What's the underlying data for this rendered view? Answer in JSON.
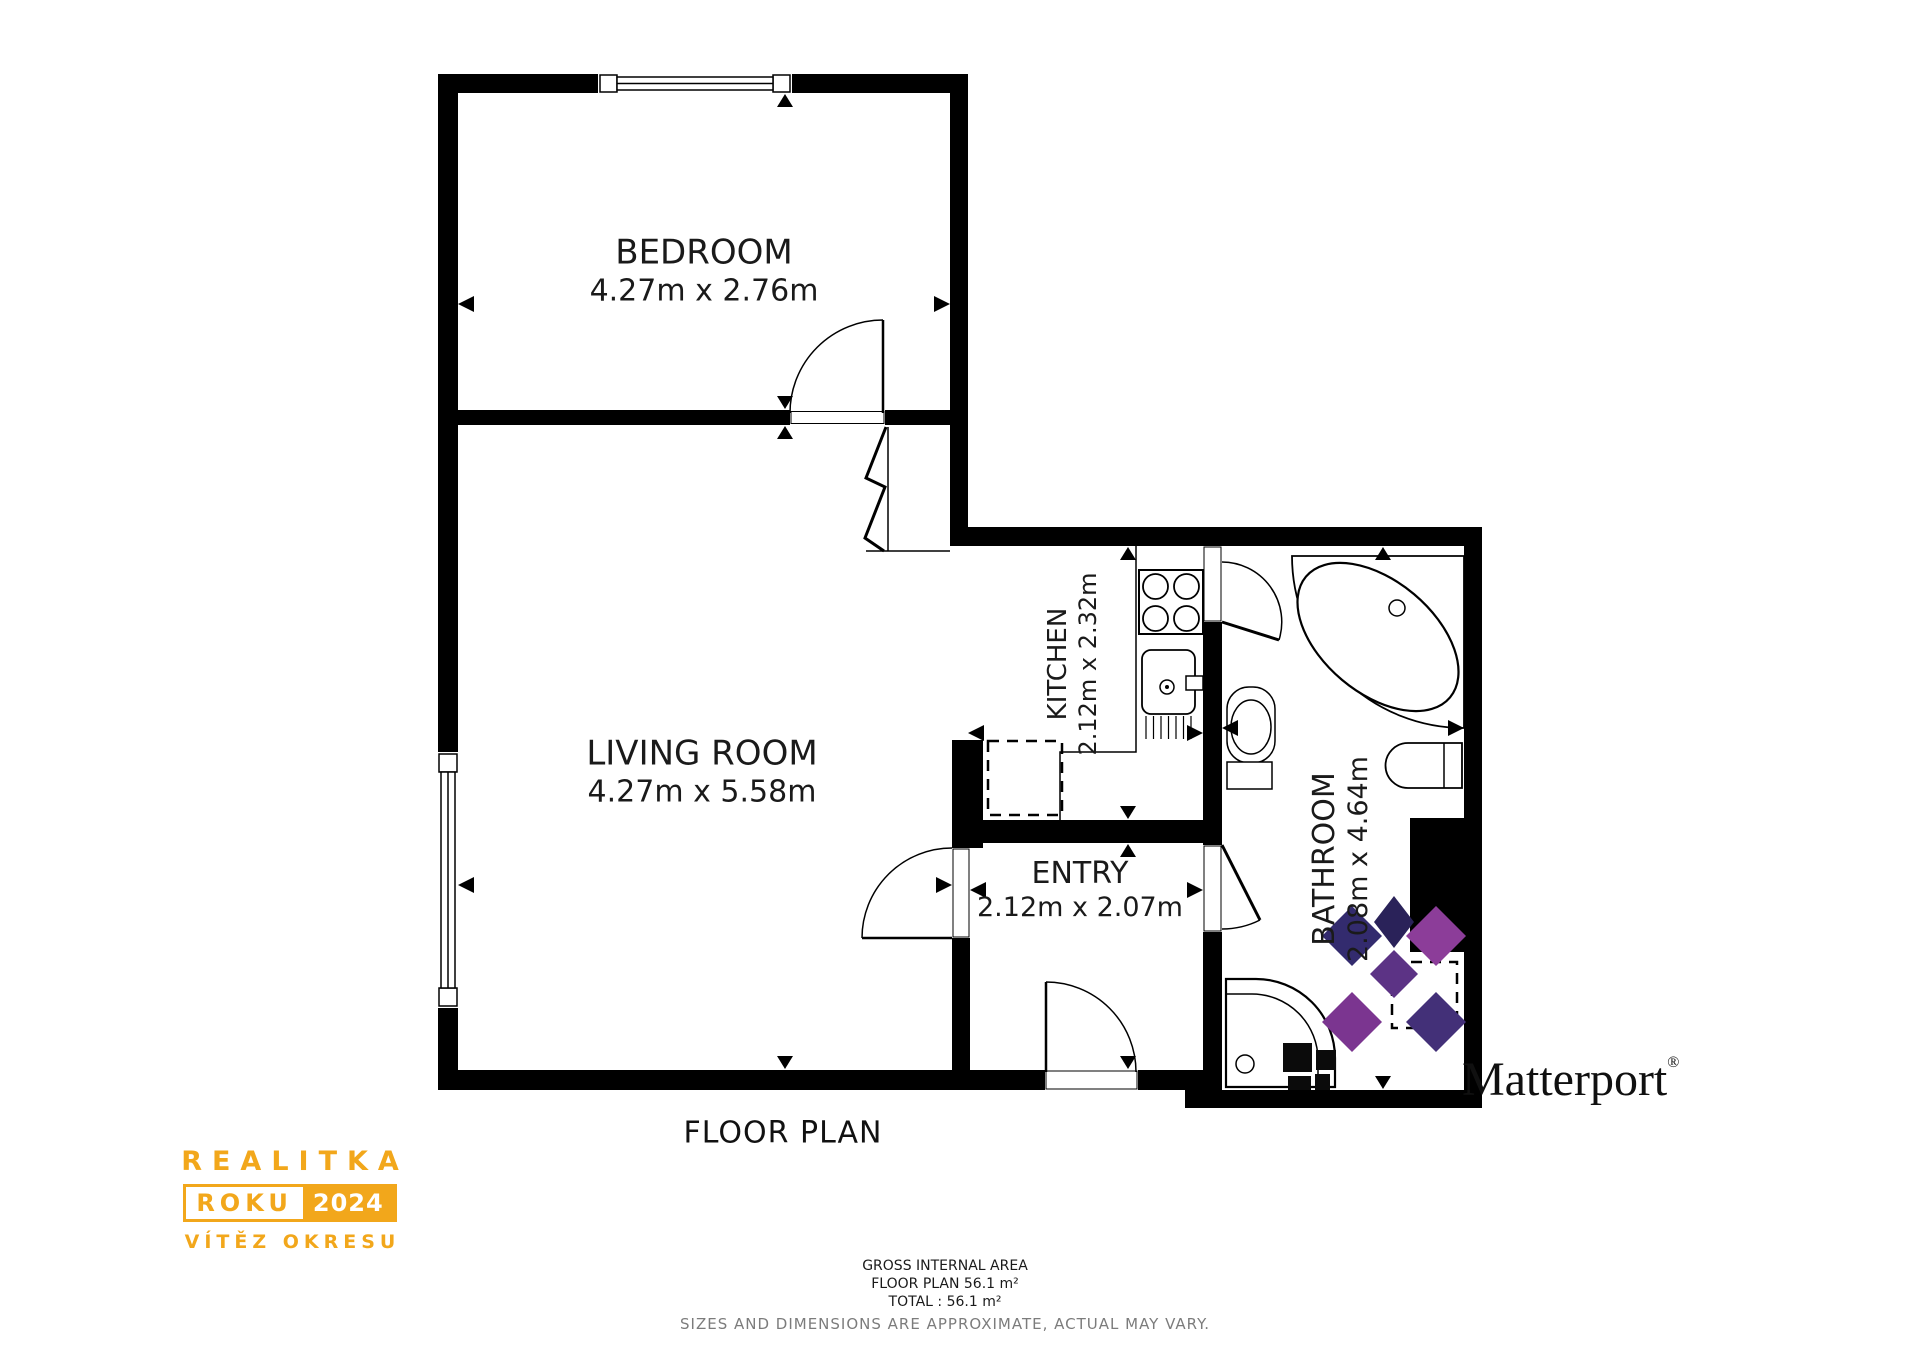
{
  "plan": {
    "title": "FLOOR PLAN",
    "rooms": {
      "bedroom": {
        "name": "BEDROOM",
        "dims": "4.27m x 2.76m"
      },
      "living_room": {
        "name": "LIVING ROOM",
        "dims": "4.27m x 5.58m"
      },
      "kitchen": {
        "name": "KITCHEN",
        "dims": "2.12m x 2.32m"
      },
      "entry": {
        "name": "ENTRY",
        "dims": "2.12m x 2.07m"
      },
      "bathroom": {
        "name": "BATHROOM",
        "dims": "2.08m x 4.64m"
      }
    }
  },
  "area_summary": {
    "gross_internal_area": "GROSS INTERNAL AREA",
    "floor_plan_area": "FLOOR PLAN 56.1 m²",
    "total_area": "TOTAL :  56.1 m²",
    "disclaimer": "SIZES AND DIMENSIONS ARE APPROXIMATE, ACTUAL MAY VARY."
  },
  "branding": {
    "realitka": {
      "line1": "REALITKA",
      "box_left": "ROKU",
      "box_right": "2024",
      "line3": "VÍTĚZ OKRESU",
      "gold": "#F2A71B"
    },
    "matterport": {
      "wordmark": "Matterport",
      "registered": "®",
      "navy": "#2B2563",
      "purple": "#8C3D99"
    }
  },
  "colors": {
    "walls": "#000000",
    "background": "#FFFFFF",
    "fine_print_gray": "#7C7C7C"
  }
}
